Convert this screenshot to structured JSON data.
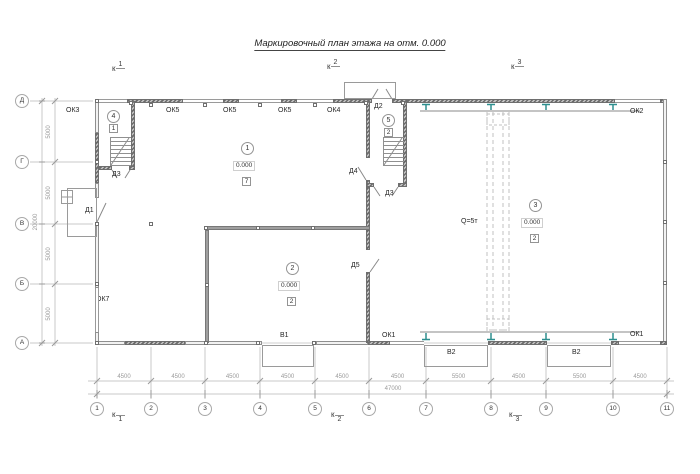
{
  "title": "Маркировочный план этажа на отм. 0.000",
  "section_letter": "к",
  "section_marks": {
    "top": [
      "1",
      "2",
      "3"
    ],
    "bottom": [
      "1",
      "2",
      "3"
    ]
  },
  "axes": {
    "rows": [
      "Д",
      "Г",
      "В",
      "Б",
      "А"
    ],
    "cols": [
      "1",
      "2",
      "3",
      "4",
      "5",
      "6",
      "7",
      "8",
      "9",
      "10",
      "11"
    ]
  },
  "dimensions": {
    "left_segments": [
      "5000",
      "5000",
      "5000",
      "5000"
    ],
    "left_total": "20000",
    "bottom_segments": [
      "4500",
      "4500",
      "4500",
      "4500",
      "4500",
      "4500",
      "5500",
      "4500",
      "5500",
      "4500"
    ],
    "bottom_total": "47000"
  },
  "rooms": {
    "r1": {
      "num": "1",
      "elevation": "0.000",
      "floor_type": "7"
    },
    "r2": {
      "num": "2",
      "elevation": "0.000",
      "floor_type": "2"
    },
    "r3": {
      "num": "3",
      "elevation": "0.000",
      "floor_type": "2"
    },
    "r4": {
      "num": "4",
      "floor_type": "1"
    },
    "r5": {
      "num": "5",
      "floor_type": "2"
    }
  },
  "openings": {
    "ok1": "ОК1",
    "ok2": "ОК2",
    "ok3": "ОК3",
    "ok4": "ОК4",
    "ok5": "ОК5",
    "ok7": "ОК7",
    "d1": "Д1",
    "d2": "Д2",
    "d3": "Д3",
    "d4": "Д4",
    "d5": "Д5",
    "v1": "В1",
    "v2": "В2"
  },
  "crane": {
    "capacity_label": "Q=5т"
  },
  "colors": {
    "wall": "#9a9a9a",
    "wall_dark": "#6a6a6a",
    "window": "#c9c9c9",
    "crane_support": "#2e8f8f",
    "line": "#c8c8c8",
    "tick": "#9a9a9a",
    "text": "#262626",
    "dim_text": "#9a9a9a"
  }
}
